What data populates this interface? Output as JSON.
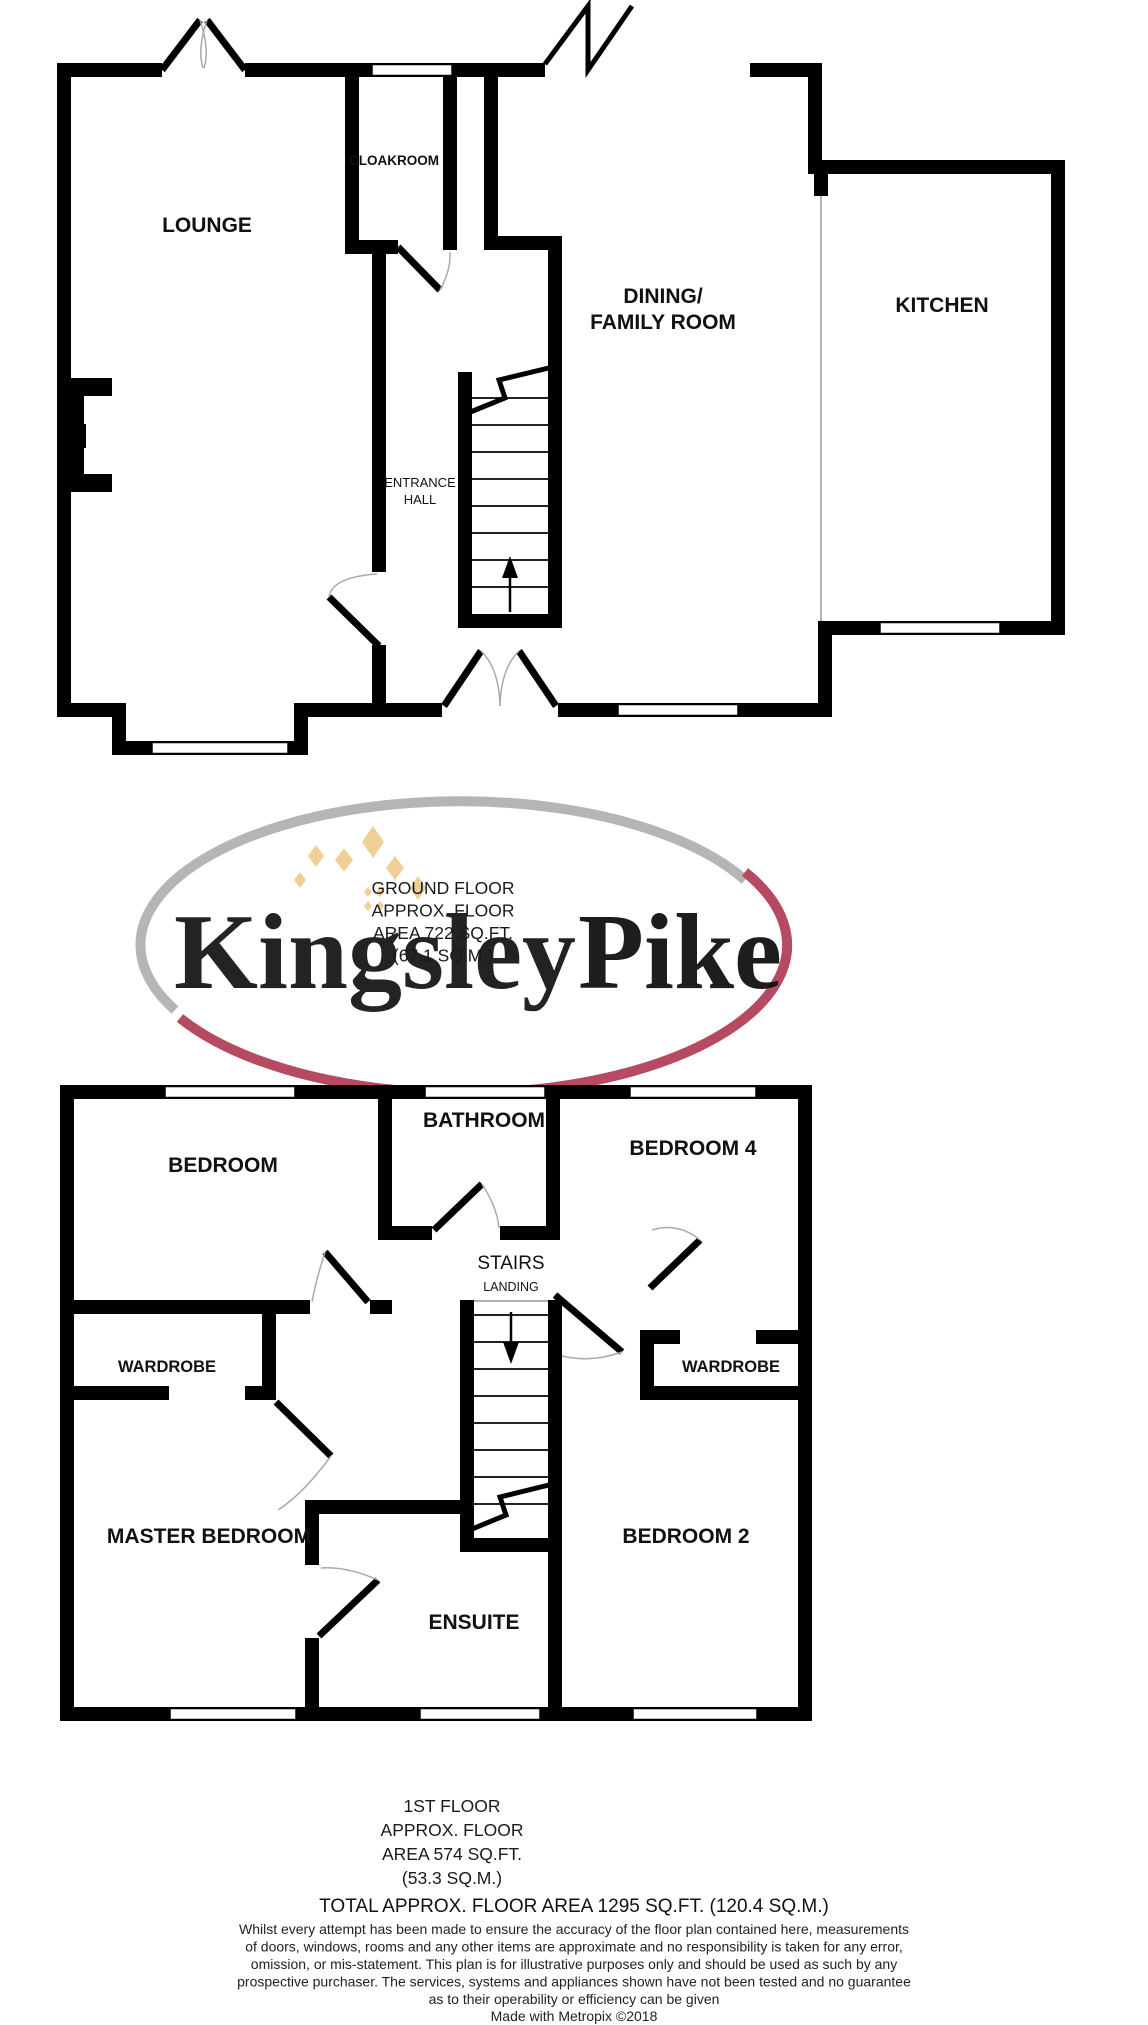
{
  "logo": {
    "brand_first": "Kingsley",
    "brand_second": "Pike",
    "accent_pink": "#c27a90",
    "accent_gray": "#b5b5b5",
    "arc_red": "#b64a62",
    "sparkle_tan": "#f0cf96"
  },
  "ground_floor": {
    "rooms": {
      "lounge": "LOUNGE",
      "cloakroom": "CLOAKROOM",
      "entrance_hall_line1": "ENTRANCE",
      "entrance_hall_line2": "HALL",
      "dining_line1": "DINING/",
      "dining_line2": "FAMILY ROOM",
      "kitchen": "KITCHEN"
    },
    "summary": [
      "GROUND FLOOR",
      "APPROX. FLOOR",
      "AREA 722 SQ.FT.",
      "(67.1 SQ.M.)"
    ]
  },
  "first_floor": {
    "rooms": {
      "bedroom": "BEDROOM",
      "bathroom": "BATHROOM",
      "bedroom4": "BEDROOM 4",
      "wardrobe_left": "WARDROBE",
      "wardrobe_right": "WARDROBE",
      "stairs": "STAIRS",
      "landing": "LANDING",
      "master_bedroom": "MASTER BEDROOM",
      "ensuite": "ENSUITE",
      "bedroom2": "BEDROOM 2"
    },
    "summary": [
      "1ST FLOOR",
      "APPROX. FLOOR",
      "AREA 574 SQ.FT.",
      "(53.3 SQ.M.)"
    ]
  },
  "totals": {
    "total_line": "TOTAL APPROX. FLOOR AREA 1295 SQ.FT. (120.4 SQ.M.)"
  },
  "disclaimer": [
    "Whilst every attempt has been made to ensure the accuracy of the floor plan contained here, measurements",
    "of doors, windows, rooms and any other items are approximate and no responsibility is taken for any error,",
    "omission, or mis-statement. This plan is for illustrative purposes only and should be used as such by any",
    "prospective purchaser. The services, systems and appliances shown have not been tested and no guarantee",
    "as to their operability or efficiency can be given"
  ],
  "credit": "Made with Metropix ©2018"
}
